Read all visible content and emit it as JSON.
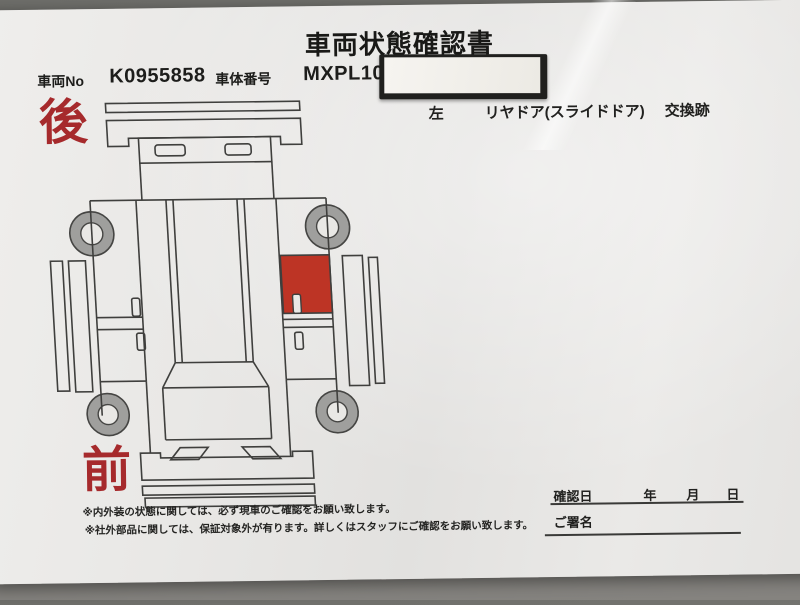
{
  "colors": {
    "highlight_red": "#bd3425",
    "label_red": "#a62a2c",
    "line": "#3f3f3d",
    "paper": "#e9e8e5",
    "background": "#73736f"
  },
  "header": {
    "title": "車両状態確認書",
    "vehicle_no_label": "車両No",
    "vehicle_no_value": "K0955858",
    "body_no_label": "車体番号",
    "body_no_value": "MXPL10-"
  },
  "damage_note": {
    "side": "左",
    "part": "リヤドア(スライドドア)",
    "finding": "交換跡"
  },
  "diagram": {
    "rear_label": "後",
    "front_label": "前",
    "highlighted_part": "left-rear-slide-door"
  },
  "notes": {
    "line1": "※内外装の状態に関しては、必ず現車のご確認をお願い致します。",
    "line2": "※社外部品に関しては、保証対象外が有ります。詳しくはスタッフにご確認をお願い致します。"
  },
  "confirmation": {
    "date_label": "確認日",
    "year_label": "年",
    "month_label": "月",
    "day_label": "日",
    "signature_label": "ご署名"
  }
}
